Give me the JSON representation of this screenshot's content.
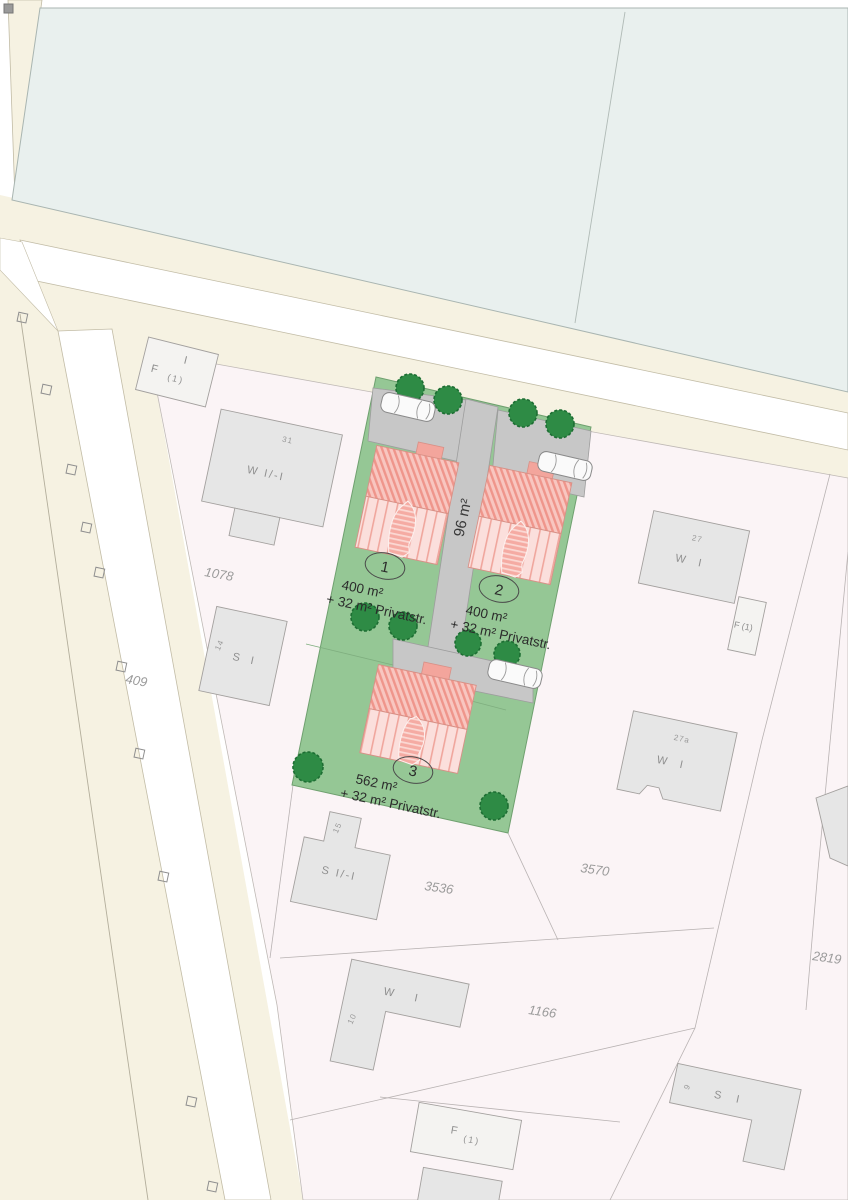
{
  "plots": [
    {
      "number": "1",
      "area": "400 m²",
      "extra": "+ 32 m² Privatstr."
    },
    {
      "number": "2",
      "area": "400 m²",
      "extra": "+ 32 m² Privatstr."
    },
    {
      "number": "3",
      "area": "562 m²",
      "extra": "+ 32 m² Privatstr."
    }
  ],
  "private_road_label": "96 m²",
  "parcel_numbers": {
    "p1078": "1078",
    "p409": "409",
    "p3536": "3536",
    "p3570": "3570",
    "p1166": "1166",
    "p2819": "2819"
  },
  "buildings": {
    "farm_nw": {
      "storeys": "I",
      "use": "F",
      "unit": "(1)"
    },
    "house_31": {
      "number": "31",
      "use": "W I/-I"
    },
    "house_14": {
      "number": "14",
      "use": "S I"
    },
    "house_27": {
      "number": "27",
      "use": "W I"
    },
    "barn_e": {
      "use": "F (1)"
    },
    "house_27a": {
      "number": "27a",
      "use": "W I"
    },
    "house_15": {
      "number": "15",
      "use": "S I/-I"
    },
    "house_10": {
      "number": "10",
      "use": "W I"
    },
    "house_9": {
      "number": "9",
      "use": "S I"
    },
    "barn_s": {
      "use": "F",
      "unit": "(1)"
    }
  },
  "colors": {
    "field_teal": "#e9f0ee",
    "road_shoulder": "#f6f2e2",
    "parcel_pink": "#fbf4f6",
    "plot_green": "#95c795",
    "paving_grey": "#c7c7c7",
    "roof_red": "#ef958b",
    "roof_light": "#fbdfdc",
    "tree_green": "#2e8b45",
    "building_grey": "#e6e6e6"
  }
}
